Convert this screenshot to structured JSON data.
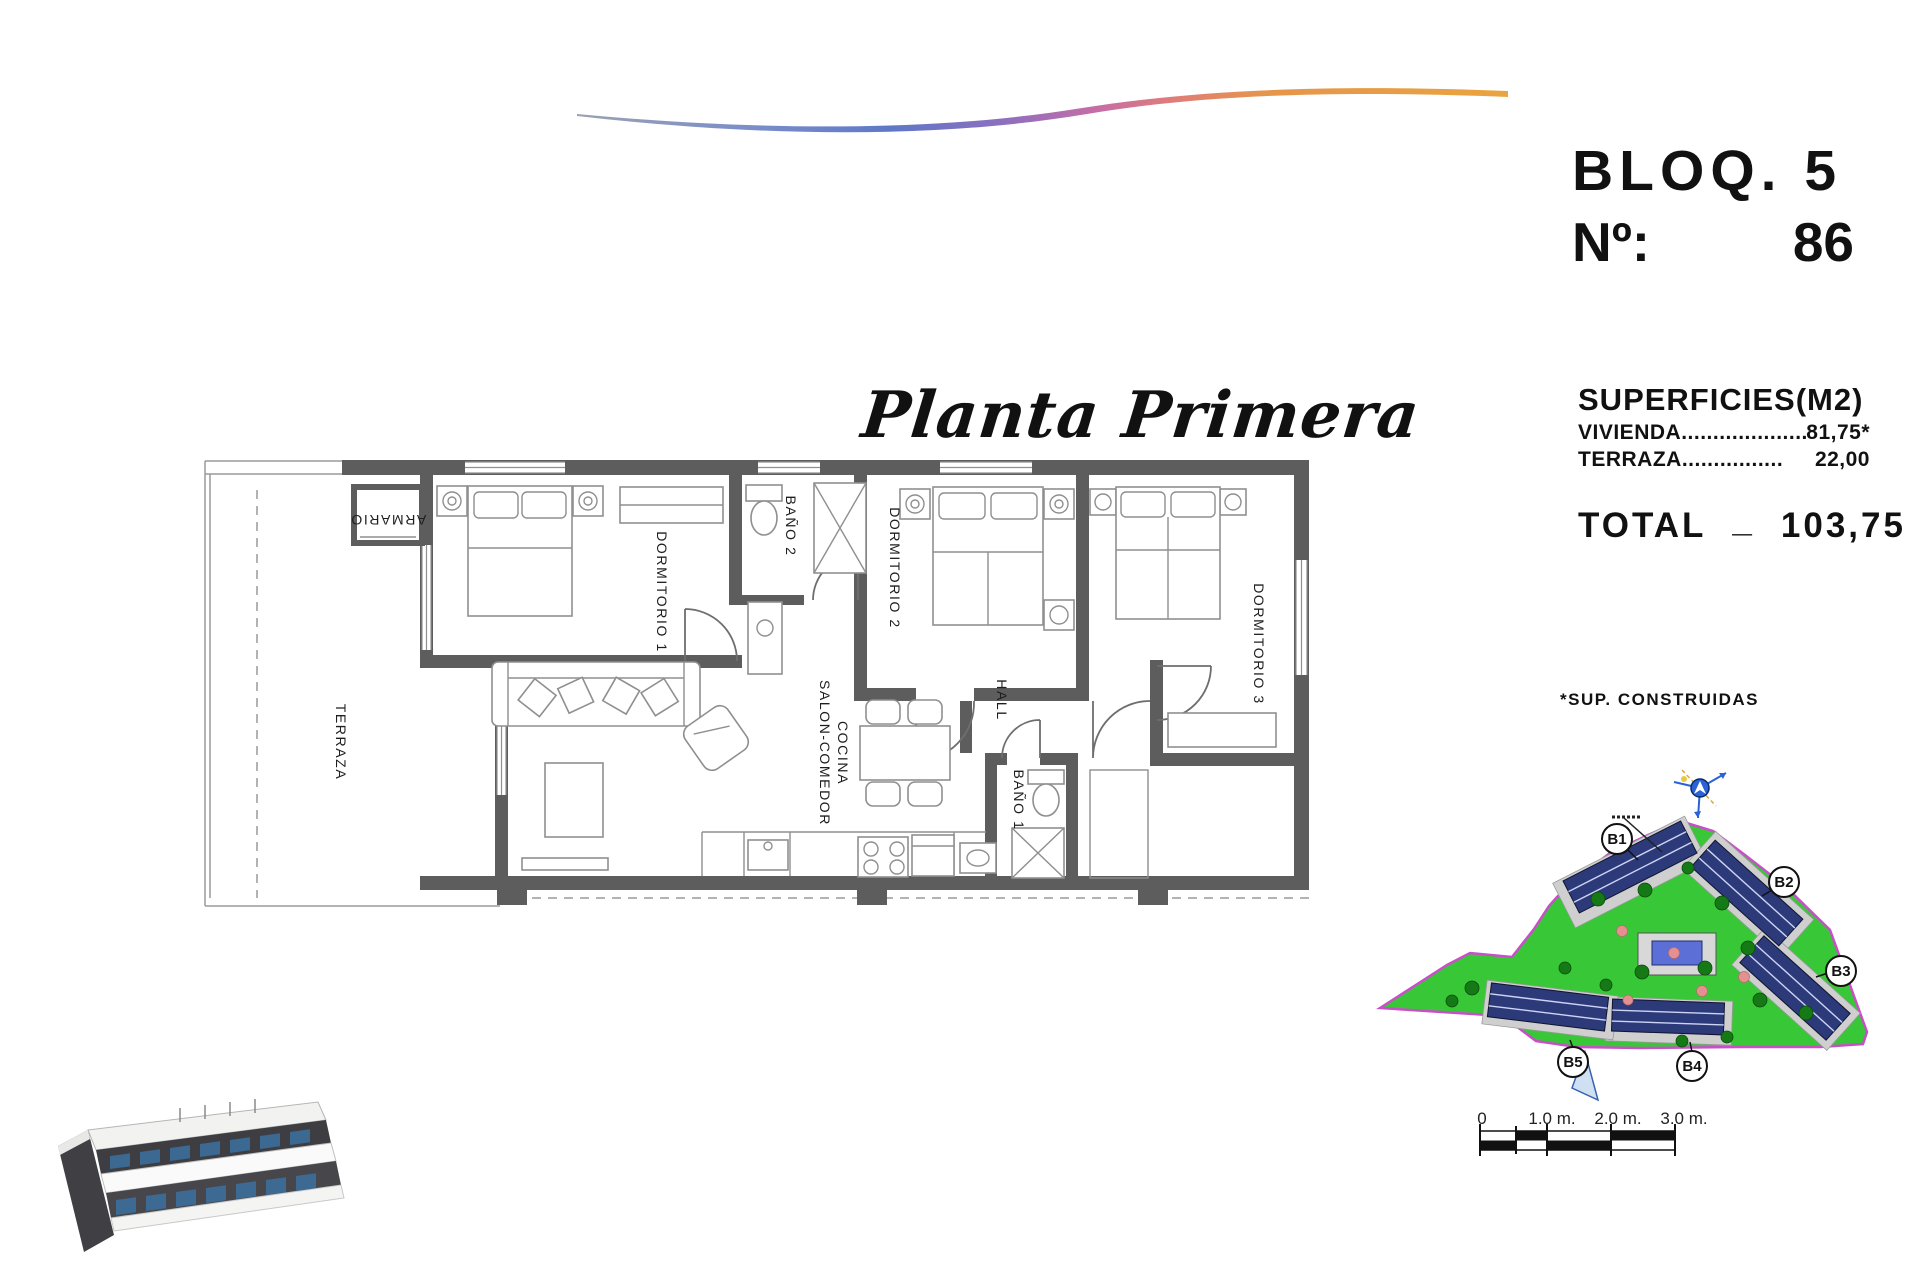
{
  "header": {
    "block": "BLOQ. 5",
    "number_label": "Nº:",
    "number_value": "86"
  },
  "title": {
    "script": "Planta Primera"
  },
  "surfaces": {
    "heading": "SUPERFICIES(M2)",
    "rows": [
      {
        "label": "VIVIENDA",
        "dots": "....................",
        "value": "81,75*"
      },
      {
        "label": "TERRAZA",
        "dots": "................",
        "value": "22,00"
      }
    ],
    "total_label": "TOTAL",
    "total_sep": "_",
    "total_value": "103,75",
    "footnote": "*SUP. CONSTRUIDAS"
  },
  "floor_plan": {
    "rooms": [
      {
        "id": "terraza",
        "label": "TERRAZA"
      },
      {
        "id": "armario",
        "label": "ARMARIO"
      },
      {
        "id": "dormitorio-1",
        "label": "DORMITORIO 1"
      },
      {
        "id": "bano-2",
        "label": "BAÑO 2"
      },
      {
        "id": "dormitorio-2",
        "label": "DORMITORIO 2"
      },
      {
        "id": "hall",
        "label": "HALL"
      },
      {
        "id": "dormitorio-3",
        "label": "DORMITORIO 3"
      },
      {
        "id": "salon",
        "label": "SALON-COMEDOR",
        "label2": "COCINA"
      },
      {
        "id": "bano-1",
        "label": "BAÑO 1"
      }
    ]
  },
  "site_plan": {
    "blocks": [
      {
        "id": "b1",
        "label": "B1"
      },
      {
        "id": "b2",
        "label": "B2"
      },
      {
        "id": "b3",
        "label": "B3"
      },
      {
        "id": "b4",
        "label": "B4"
      },
      {
        "id": "b5",
        "label": "B5"
      }
    ]
  },
  "scale_bar": {
    "labels": [
      "0",
      "1.0 m.",
      "2.0 m.",
      "3.0 m."
    ]
  },
  "colors": {
    "wall_gray": "#5d5d5d",
    "site_green": "#38c736",
    "site_border": "#c94fc9",
    "building_navy": "#2c3a7a",
    "pool_blue": "#5b6fd6",
    "line_blue": "#1f4e79",
    "swoosh": [
      "#9aa2b2",
      "#5f78c6",
      "#8e6fbe",
      "#c76da6",
      "#de7d78",
      "#eaa43f"
    ]
  }
}
